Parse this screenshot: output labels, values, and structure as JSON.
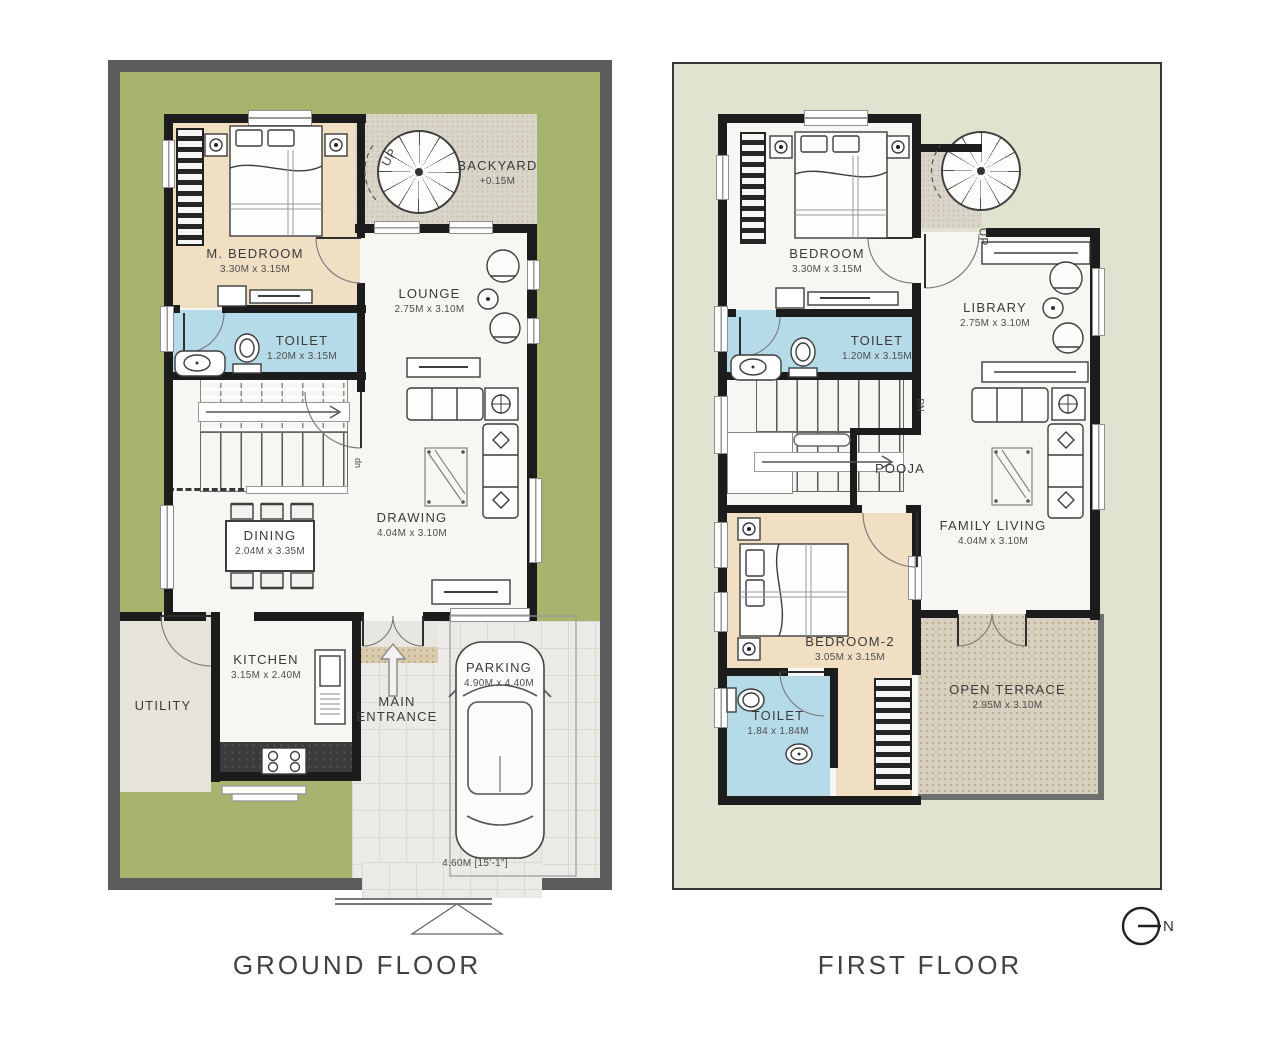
{
  "ground_floor": {
    "title": "GROUND FLOOR",
    "stair_label": "up",
    "spiral_label": "UP",
    "rooms": {
      "m_bedroom": {
        "name": "M. BEDROOM",
        "dims": "3.30M x 3.15M"
      },
      "toilet": {
        "name": "TOILET",
        "dims": "1.20M x 3.15M"
      },
      "backyard": {
        "name": "BACKYARD",
        "level": "+0.15M"
      },
      "lounge": {
        "name": "LOUNGE",
        "dims": "2.75M x 3.10M"
      },
      "drawing": {
        "name": "DRAWING",
        "dims": "4.04M x 3.10M"
      },
      "dining": {
        "name": "DINING",
        "dims": "2.04M x 3.35M"
      },
      "kitchen": {
        "name": "KITCHEN",
        "dims": "3.15M x 2.40M"
      },
      "utility": {
        "name": "UTILITY"
      },
      "main_entrance": {
        "name": "MAIN ENTRANCE"
      },
      "parking": {
        "name": "PARKING",
        "dims": "4.90M x 4.40M",
        "stall_dim": "4.60M [15'-1\"]"
      }
    }
  },
  "first_floor": {
    "title": "FIRST FLOOR",
    "stair_label": "DN",
    "spiral_label": "UP",
    "rooms": {
      "bedroom": {
        "name": "BEDROOM",
        "dims": "3.30M x 3.15M"
      },
      "toilet": {
        "name": "TOILET",
        "dims": "1.20M x 3.15M"
      },
      "library": {
        "name": "LIBRARY",
        "dims": "2.75M x 3.10M"
      },
      "pooja": {
        "name": "POOJA"
      },
      "family_living": {
        "name": "FAMILY LIVING",
        "dims": "4.04M x 3.10M"
      },
      "bedroom2": {
        "name": "BEDROOM-2",
        "dims": "3.05M x 3.15M"
      },
      "toilet2": {
        "name": "TOILET",
        "dims": "1.84 x 1.84M"
      },
      "open_terrace": {
        "name": "OPEN TERRACE",
        "dims": "2.95M x 3.10M"
      }
    }
  },
  "compass": {
    "label": "N"
  },
  "colors": {
    "yard_green": "#a7b46e",
    "sage_plot": "#dfe3cf",
    "toilet_blue": "#b5dbe9",
    "bedroom_tan": "#f1dfc3",
    "marble_white": "#f7f6f3",
    "concrete": "#d9d5c9",
    "terrace_speckle": "#d8d0bf",
    "tiles": "#eceae6",
    "wall_black": "#1c1c1c",
    "compound_gray": "#5c5c5c",
    "counter_dark": "#3b3b3b"
  }
}
